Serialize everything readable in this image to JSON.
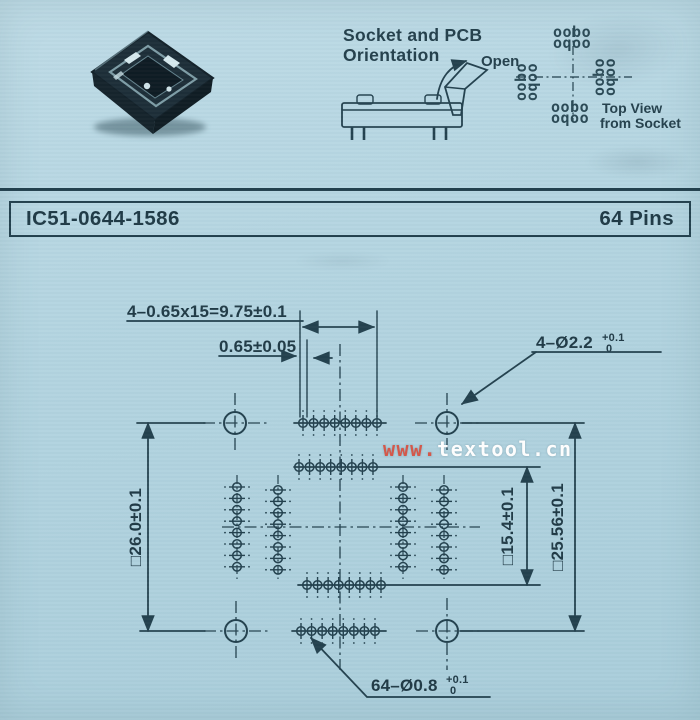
{
  "colors": {
    "background": "#b2d3df",
    "ink": "#23414e",
    "watermark_red": "#d4584a",
    "watermark_white": "#fdfdfd"
  },
  "orientation": {
    "title_line1": "Socket and PCB",
    "title_line2": "Orientation",
    "open_label": "Open"
  },
  "top_view": {
    "cluster_row1": "oobo",
    "cluster_row2": "oqoo",
    "label_line1": "Top View",
    "label_line2": "from Socket"
  },
  "header": {
    "part_number": "IC51-0644-1586",
    "pin_count": "64 Pins"
  },
  "watermark": {
    "prefix": "www.",
    "domain": "textool.cn"
  },
  "dimensions": {
    "pin_pitch_total": "4–0.65x15=9.75±0.1",
    "pin_pitch": "0.65±0.05",
    "corner_holes": "4–Ø2.2",
    "corner_holes_tol_upper": "+0.1",
    "corner_holes_tol_lower": "0",
    "body_size": "□26.0±0.1",
    "inner_row_span": "□15.4±0.1",
    "outer_row_span": "□25.56±0.1",
    "pin_holes": "64–Ø0.8",
    "pin_holes_tol_upper": "+0.1",
    "pin_holes_tol_lower": "0"
  }
}
